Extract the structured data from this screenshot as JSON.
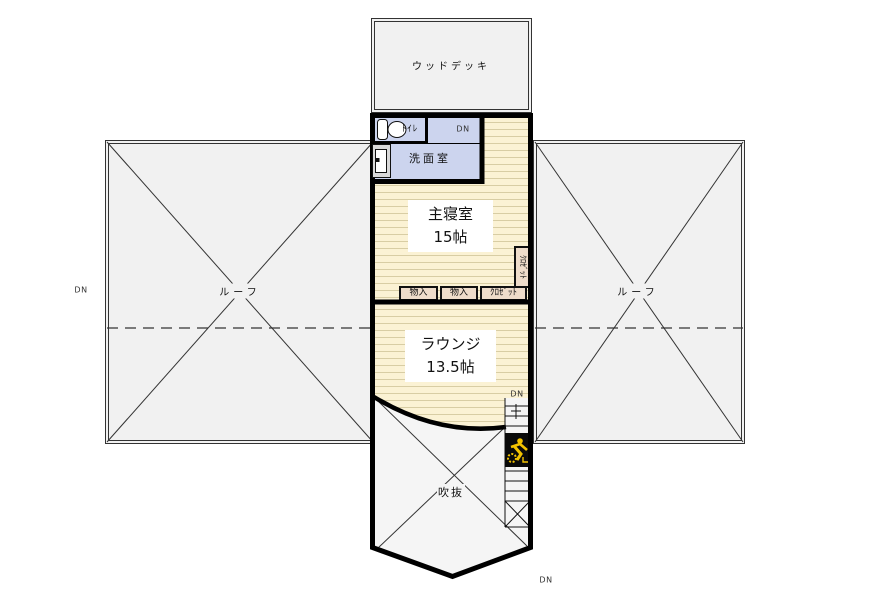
{
  "rooms": {
    "wood_deck": {
      "label": "ウッドデッキ"
    },
    "toilet": {
      "label": "ﾄｲﾚ"
    },
    "washroom": {
      "label": "洗面室"
    },
    "master_bedroom": {
      "name": "主寝室",
      "size": "15帖"
    },
    "lounge": {
      "name": "ラウンジ",
      "size": "13.5帖"
    },
    "void": {
      "label": "吹抜"
    },
    "roof_left": {
      "label": "ルーフ"
    },
    "roof_right": {
      "label": "ルーフ"
    }
  },
  "storage": {
    "closet_side_vertical": "ｸﾛｾﾞｯﾄ",
    "storage_1": "物入",
    "storage_2": "物入",
    "closet_row": "ｸﾛｾﾞｯﾄ"
  },
  "stair_labels": {
    "dn_washroom": "DN",
    "dn_left": "DN",
    "dn_lounge": "DN",
    "dn_bottom": "DN"
  },
  "colors": {
    "floor_cream": "#fbf2d4",
    "floor_stripe": "#d8cda4",
    "wet_room_blue": "#ccd4ee",
    "roof_gray": "#f1f1f1",
    "void_gray": "#f5f5f5",
    "storage_tan": "#eedcca",
    "wall_black": "#000000",
    "hazard_yellow": "#f2c200"
  }
}
